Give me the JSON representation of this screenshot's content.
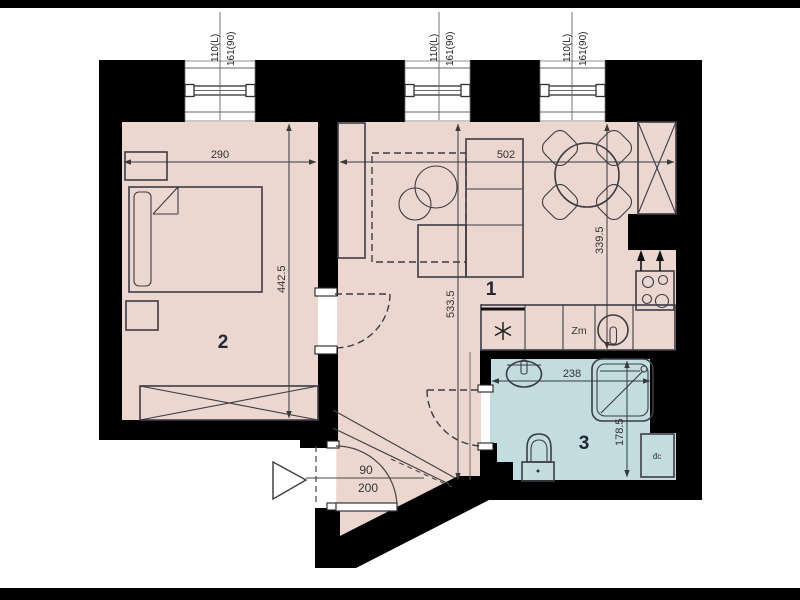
{
  "title": "apartment-floor-plan",
  "colors": {
    "wall": "#000000",
    "floor": "#ebd7d0",
    "bathroom_floor": "#c2dcdf",
    "outline": "#3c3c44",
    "dimension": "#3a3a3a",
    "room_label": "#232636"
  },
  "rooms": [
    {
      "number": "1"
    },
    {
      "number": "2"
    },
    {
      "number": "3"
    }
  ],
  "windows": [
    {
      "dim_a": "110(L)",
      "dim_b": "161(90)"
    },
    {
      "dim_a": "110(L)",
      "dim_b": "161(90)"
    },
    {
      "dim_a": "110(L)",
      "dim_b": "161(90)"
    }
  ],
  "dimensions": {
    "room2_width": "290",
    "room2_depth": "442.5",
    "room1_width": "502",
    "room1_depth": "533.5",
    "kitchen_depth": "339.5",
    "bathroom_width": "238",
    "bathroom_depth": "178.5"
  },
  "entry_door": {
    "width": "90",
    "height": "200"
  },
  "labels": {
    "kitchen_unit": "Zm",
    "bathroom_unit": "đc"
  }
}
